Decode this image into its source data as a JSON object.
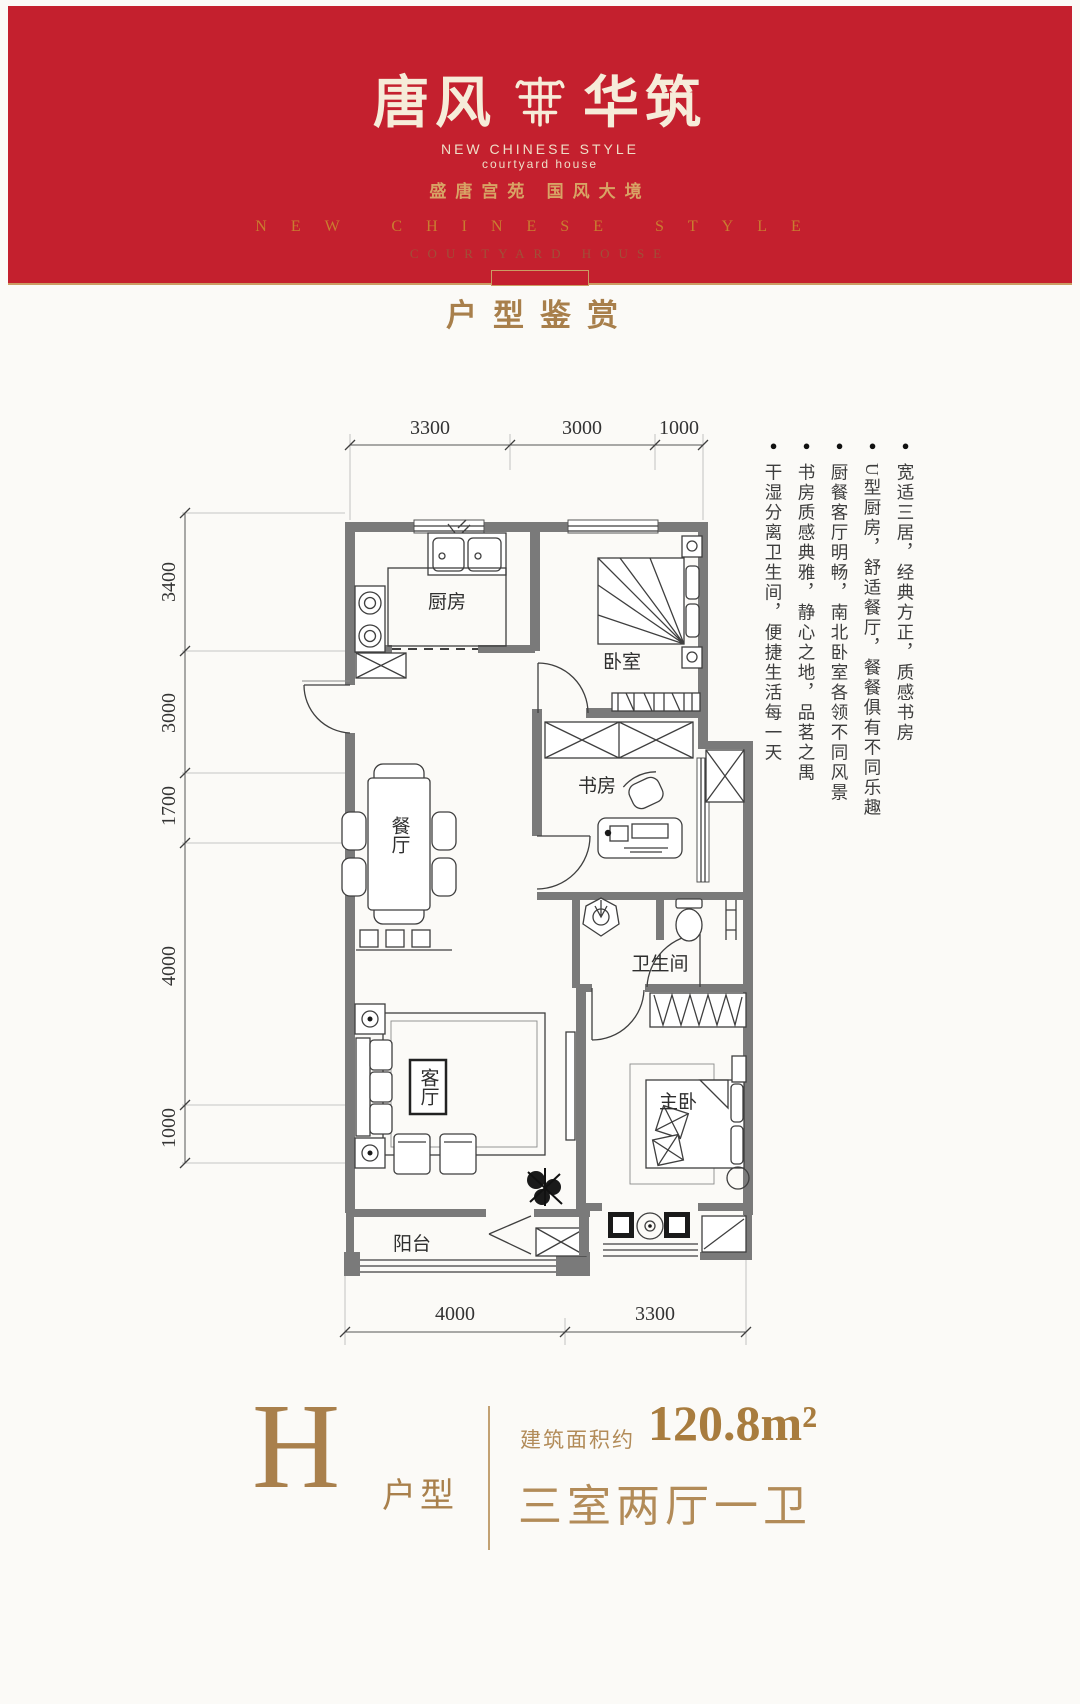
{
  "banner": {
    "logo_left": "唐风",
    "logo_right": "华筑",
    "logo_sub1": "NEW CHINESE STYLE",
    "logo_sub2": "courtyard house",
    "slogan": "盛唐宫苑  国风大境",
    "style_en": "NEW CHINESE STYLE",
    "style_en2": "COURTYARD HOUSE"
  },
  "section_title": "户型鉴赏",
  "plan": {
    "rooms": {
      "kitchen": "厨房",
      "bedroom": "卧室",
      "study": "书房",
      "dining": "餐厅",
      "bath": "卫生间",
      "living": "客厅",
      "master": "主卧",
      "balcony": "阳台"
    },
    "dims": {
      "top": [
        "3300",
        "3000",
        "1000"
      ],
      "left": [
        "3400",
        "3000",
        "1700",
        "4000",
        "1000"
      ],
      "bottom": [
        "4000",
        "3300"
      ]
    }
  },
  "features": {
    "items": [
      "宽适三居，经典方正，质感书房",
      "U型厨房，舒适餐厅，餐餐俱有不同乐趣",
      "厨餐客厅明畅，南北卧室各领不同风景",
      "书房质感典雅，静心之地，品茗之禺",
      "干湿分离卫生间，便捷生活每一天"
    ]
  },
  "footer": {
    "type_letter": "H",
    "type_label": "户型",
    "area_prefix": "建筑面积约",
    "area_value": "120.8m²",
    "layout": "三室两厅一卫"
  },
  "colors": {
    "red": "#c4202e",
    "gold": "#a9804c"
  }
}
